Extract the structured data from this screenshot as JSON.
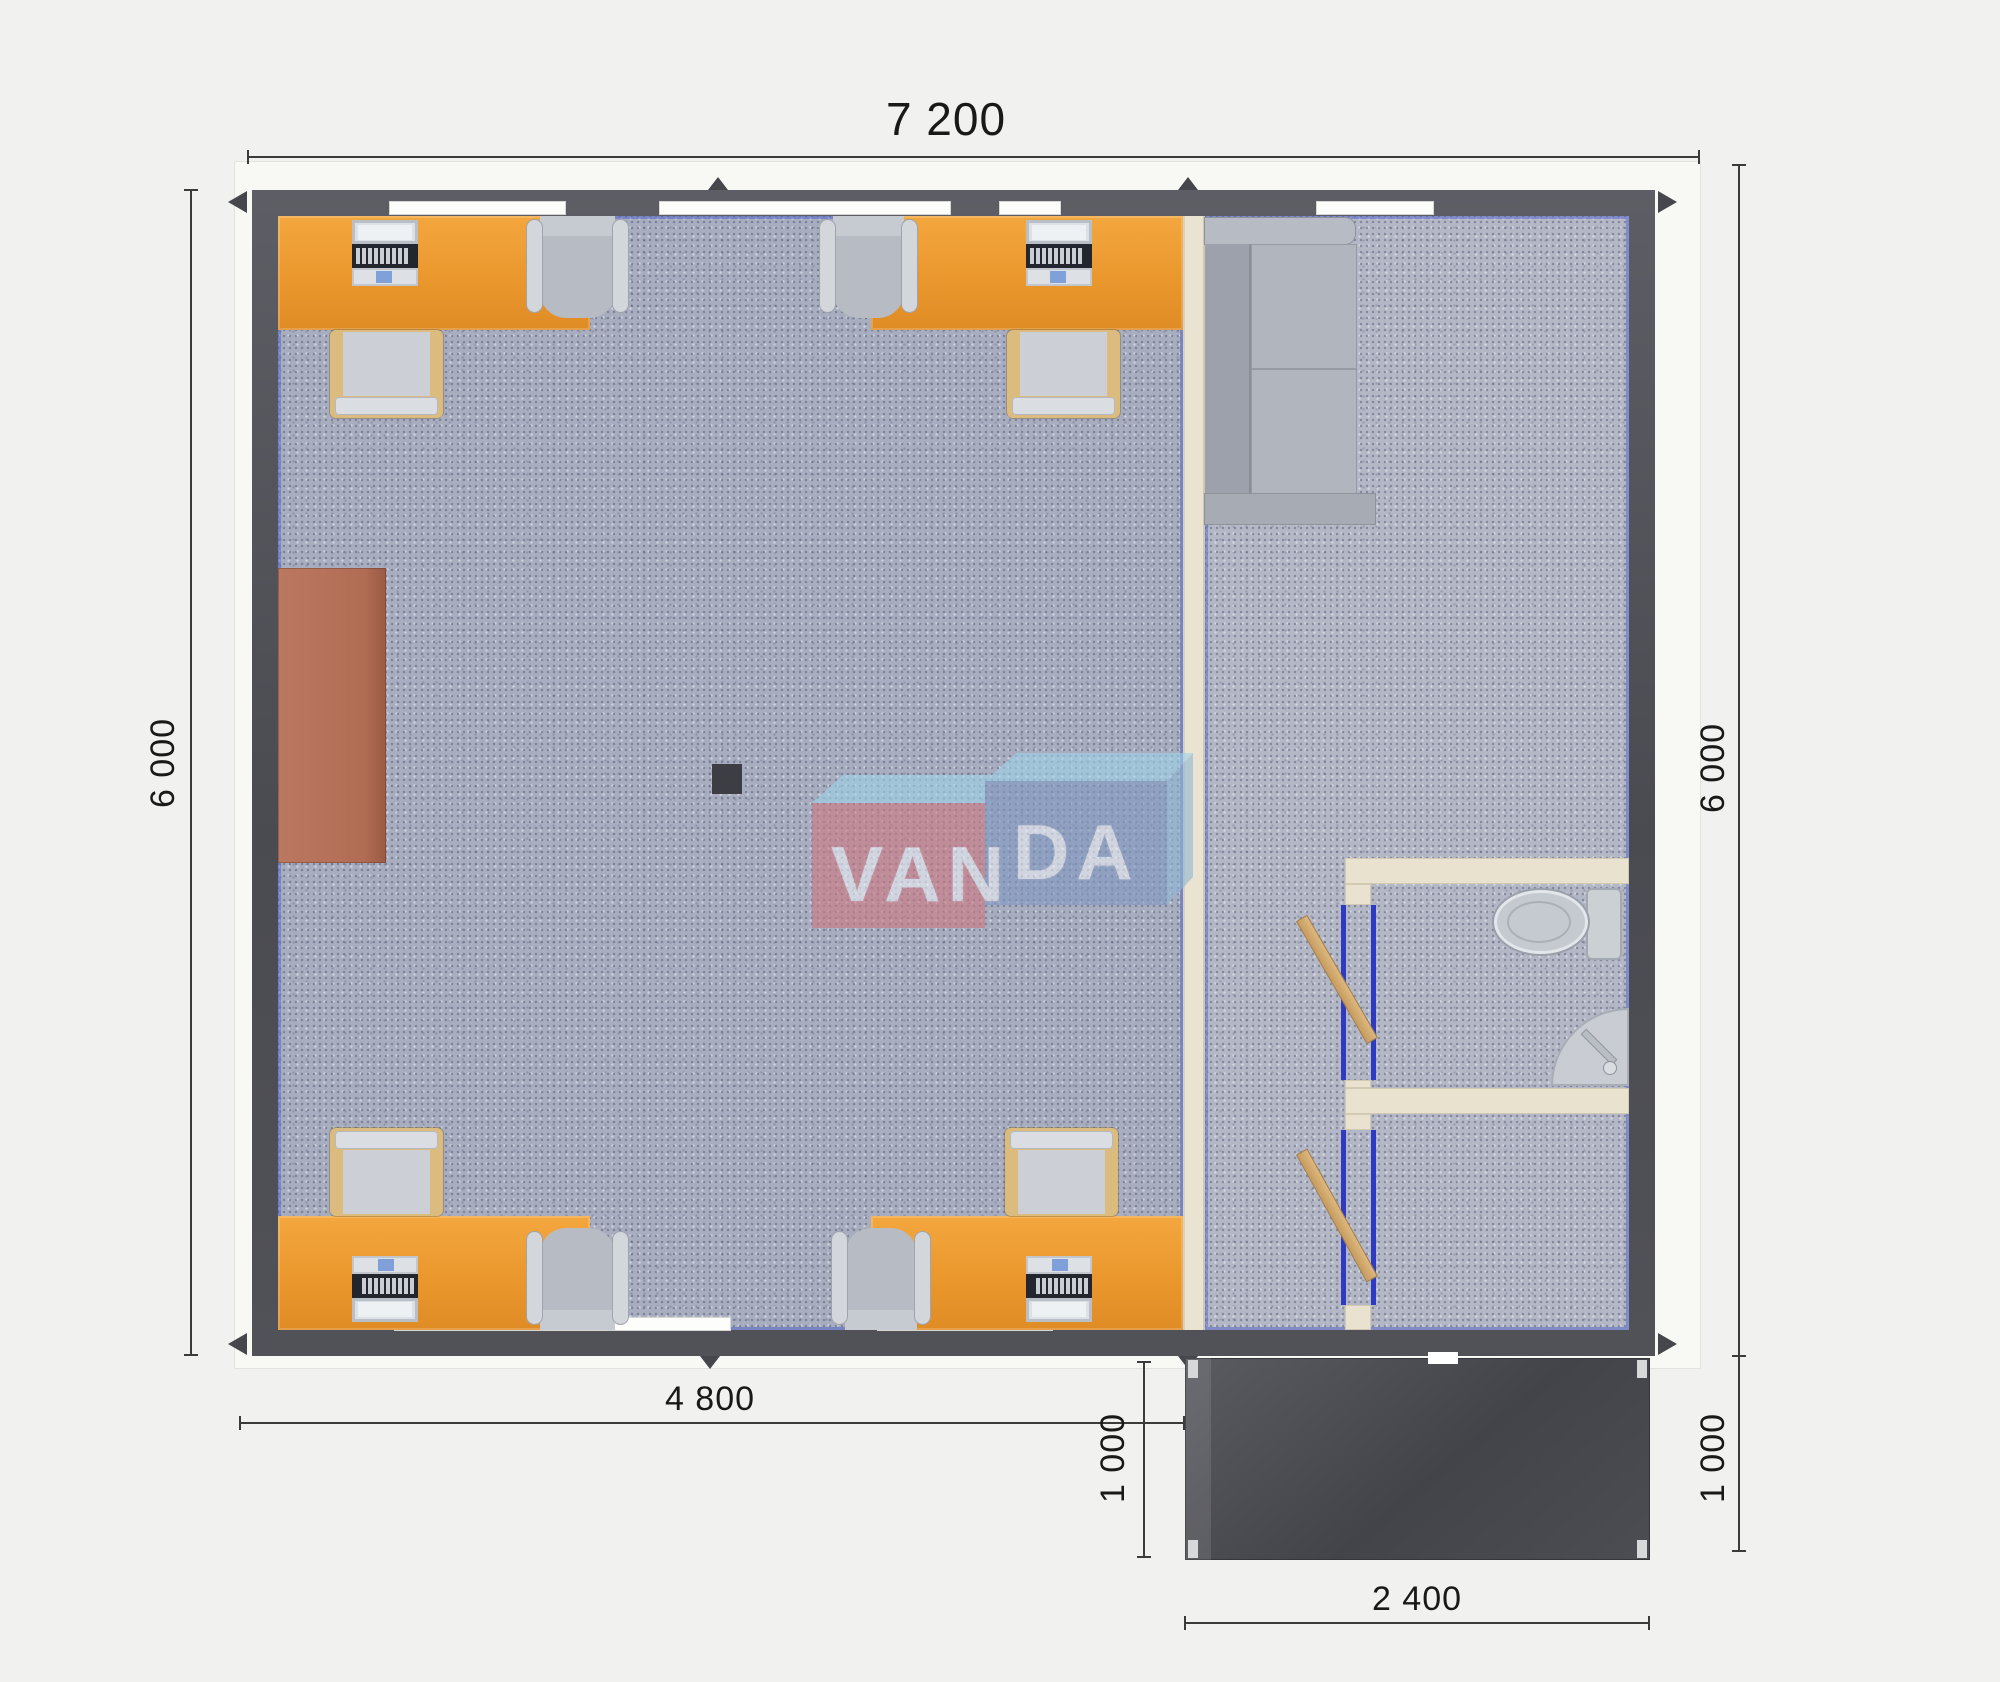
{
  "page": {
    "background": "#f1f1ef",
    "type": "modular office floor plan render"
  },
  "dimensions": {
    "top": "7 200",
    "left": "6 000",
    "right": "6 000",
    "bottom_left": "4 800",
    "porch_left": "1 000",
    "porch_right": "1 000",
    "porch_bottom": "2 400"
  },
  "watermark": {
    "van": "VAN",
    "da": "DA",
    "pink_block": "#cf7680",
    "blue_block": "#8097c1",
    "bevel": "#9fd3ea",
    "letter_color": "#edf0f5"
  },
  "palette": {
    "wall": "#4c4d53",
    "trim": "#f8f8f5",
    "office_floor": "#a8aebf",
    "hall_floor": "#b4b8c6",
    "desk_orange": "#eb9a30",
    "cabinet_brown": "#b56f57",
    "partition_cream": "#e9e2cf",
    "door_wood": "#d0a86b",
    "door_frame_blue": "#2e3ac0",
    "porch_dark": "#46474c",
    "accent_blue": "#4054c8",
    "dimension_text": "#191919"
  }
}
